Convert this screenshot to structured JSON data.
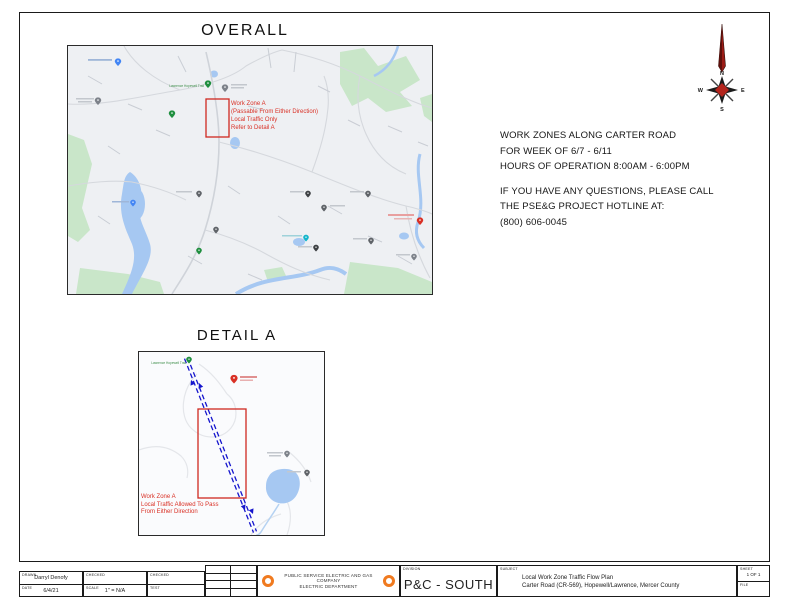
{
  "sheet": {
    "overall_title": "OVERALL",
    "detail_title": "DETAIL A"
  },
  "notice": {
    "line1": "WORK ZONES ALONG CARTER ROAD",
    "line2": "FOR WEEK OF 6/7 - 6/11",
    "line3": "HOURS OF OPERATION 8:00AM - 6:00PM",
    "line4": "IF YOU HAVE ANY QUESTIONS, PLEASE CALL",
    "line5": "THE PSE&G PROJECT HOTLINE AT:",
    "line6": "(800) 606-0045"
  },
  "overall_map": {
    "annotation": {
      "line1": "Work Zone A",
      "line2": "(Passable From Either Direction)",
      "line3": "Local Traffic Only",
      "line4": "Refer to Detail A"
    },
    "poi_label": "Lawrence Hopewell Trail"
  },
  "detail_map": {
    "annotation": {
      "line1": "Work Zone A",
      "line2": "Local Traffic Allowed To Pass",
      "line3": "From Either Direction"
    },
    "poi_label": "Lawrence Hopewell Trail"
  },
  "compass": {
    "north": "N",
    "east": "E",
    "south": "S",
    "west": "W"
  },
  "title_block": {
    "drawn_label": "DRAWN",
    "drawn_value": "Darryl Denofy",
    "date_label": "DATE",
    "date_value": "6/4/21",
    "checked_label_1": "CHECKED",
    "scale_label": "SCALE",
    "scale_value": "1\" = N/A",
    "checked_label_2": "CHECKED",
    "test_label": "TEST",
    "company_name": "PUBLIC SERVICE ELECTRIC AND GAS COMPANY",
    "company_dept": "ELECTRIC DEPARTMENT",
    "division_label": "DIVISION",
    "division_value": "P&C - SOUTH",
    "subject_label": "SUBJECT",
    "subject_line1": "Local Work Zone Traffic Flow Plan",
    "subject_line2": "Carter Road (CR-569), Hopewell/Lawrence, Mercer County",
    "sheet_label": "SHEET",
    "sheet_value": "1 OF 1",
    "file_label": "FILE"
  },
  "colors": {
    "work_zone_red": "#d93025",
    "route_blue": "#1515cd",
    "park_green": "#c9e6c9",
    "water_blue": "#a6c8f2",
    "logo_orange": "#f07a1f"
  }
}
